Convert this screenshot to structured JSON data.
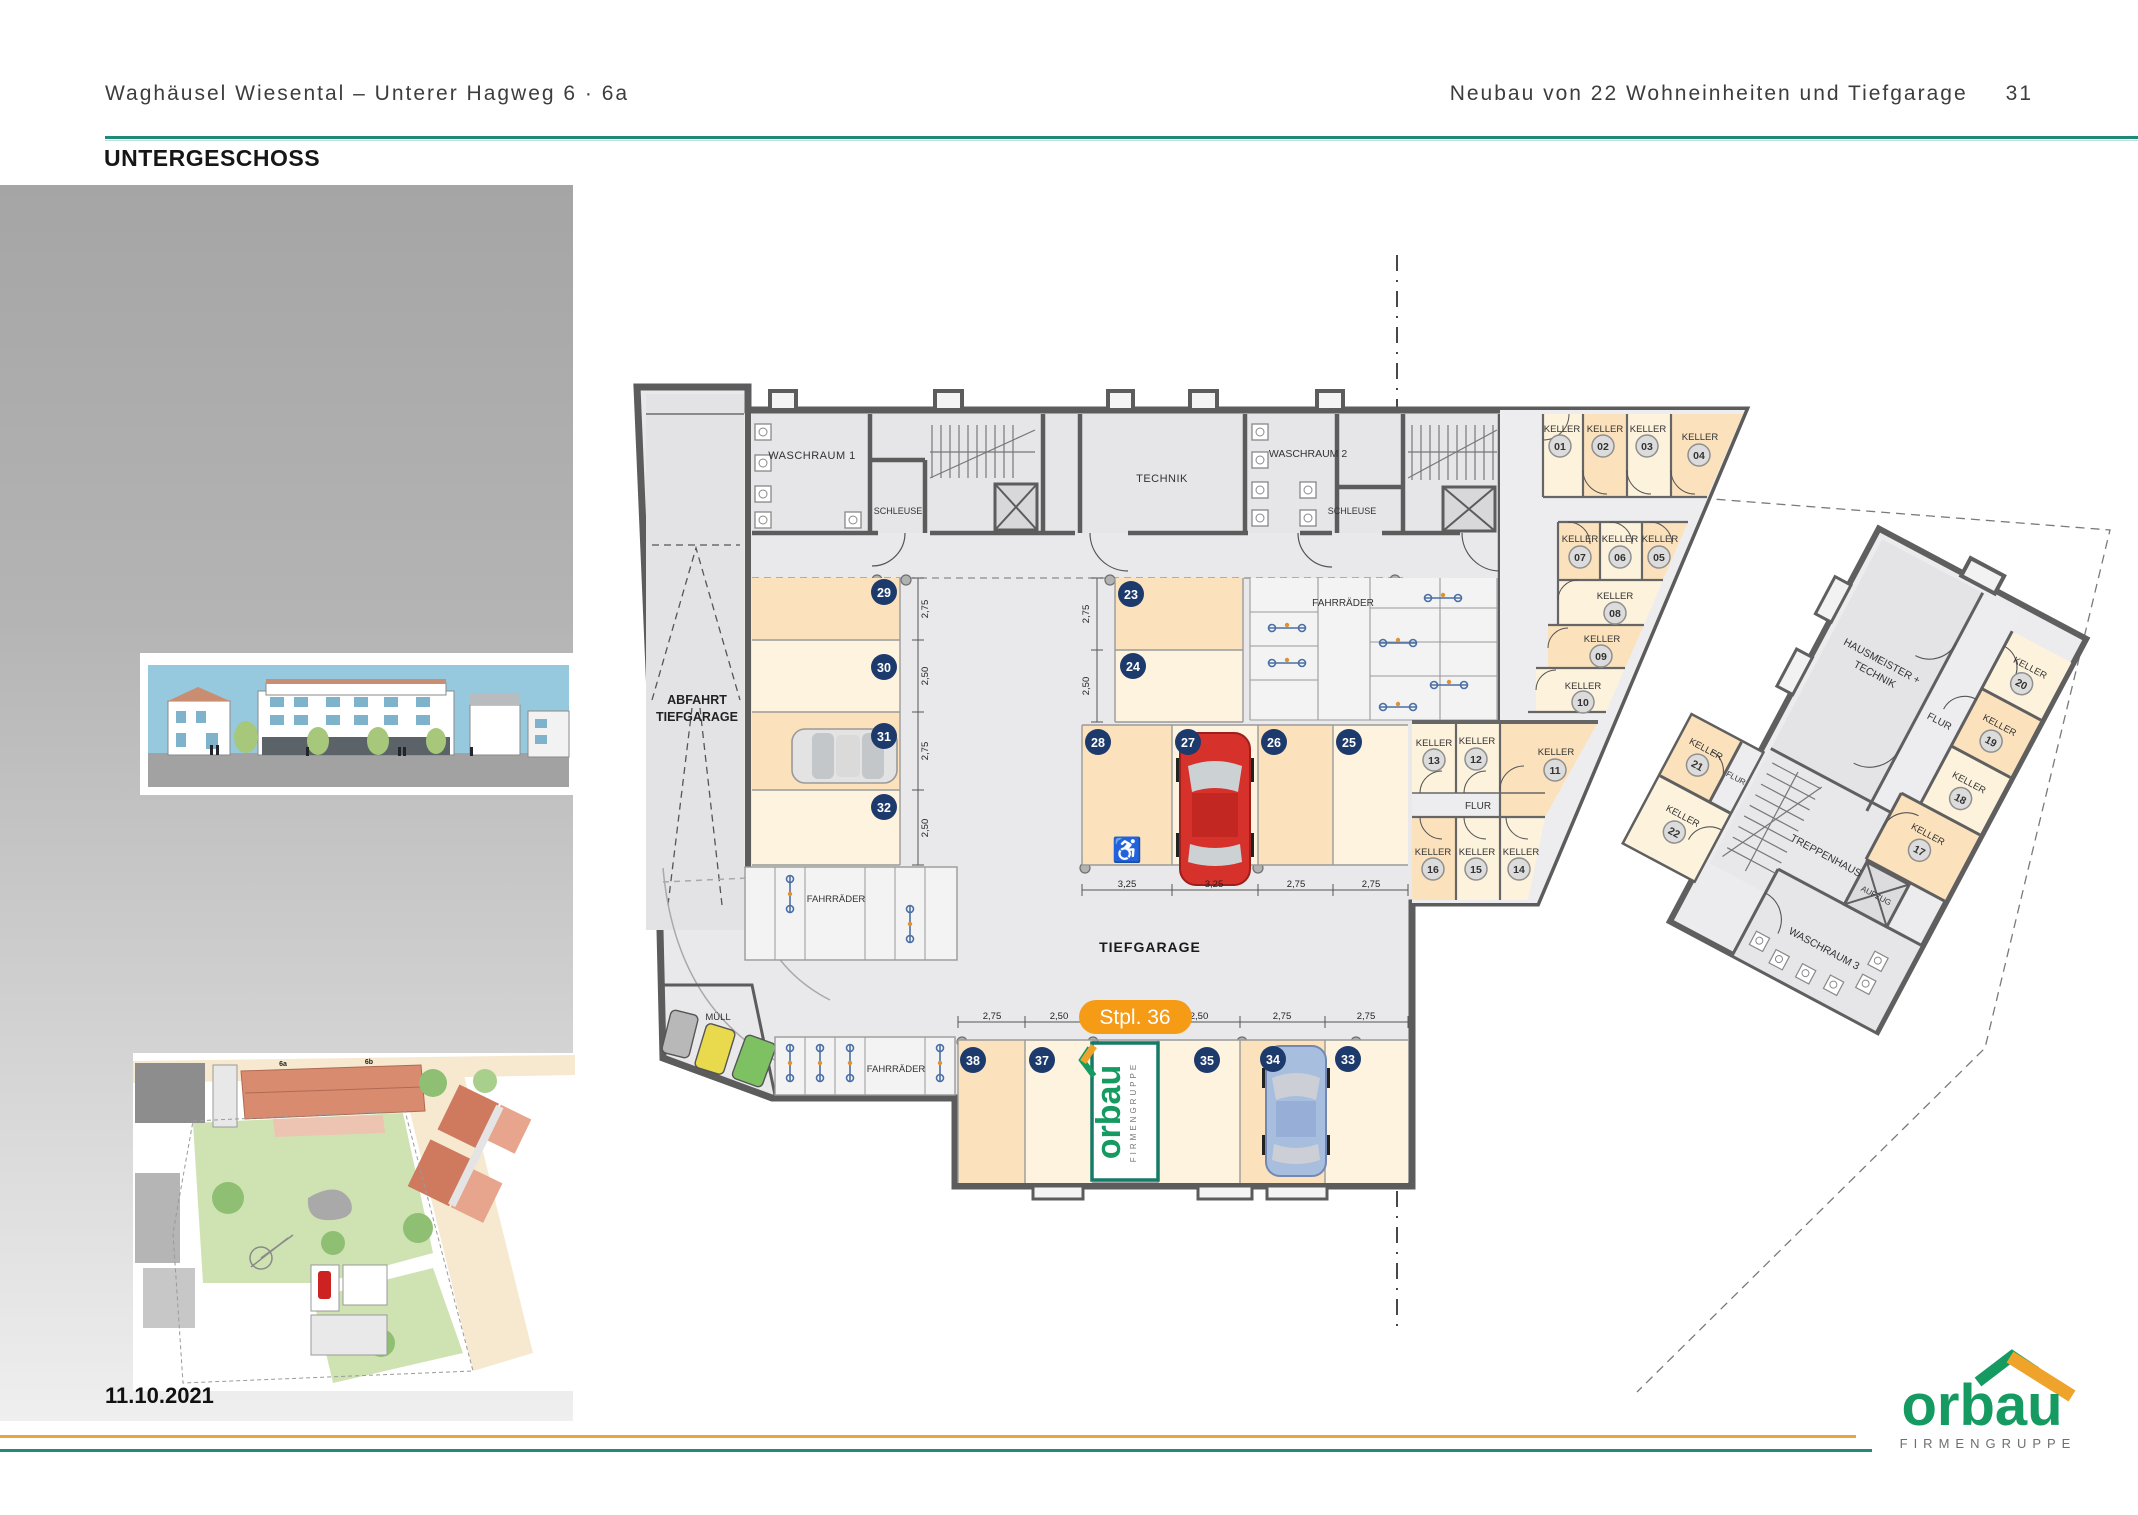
{
  "header": {
    "project": "Waghäusel Wiesental – Unterer Hagweg 6 · 6a",
    "subtitle": "Neubau von 22 Wohneinheiten und Tiefgarage",
    "page": "31"
  },
  "page_title": "UNTERGESCHOSS",
  "date": "11.10.2021",
  "logo": {
    "name": "orbau",
    "tagline": "FIRMENGRUPPE"
  },
  "plan": {
    "labels": {
      "abfahrt1": "ABFAHRT",
      "abfahrt2": "TIEFGARAGE",
      "waschraum1": "WASCHRAUM 1",
      "schleuse": "SCHLEUSE",
      "technik": "TECHNIK",
      "waschraum2": "WASCHRAUM 2",
      "fahrraeder": "FAHRRÄDER",
      "muell": "MÜLL",
      "tiefgarage": "TIEFGARAGE",
      "keller": "KELLER",
      "flur": "FLUR",
      "badge": "Stpl. 36"
    },
    "right_building": {
      "hausmeister1": "HAUSMEISTER +",
      "hausmeister2": "TECHNIK",
      "flur": "FLUR",
      "treppenhaus": "TREPPENHAUS",
      "aufzug": "AUFZUG",
      "waschraum3": "WASCHRAUM 3"
    },
    "keller_numbers": {
      "k01": "01",
      "k02": "02",
      "k03": "03",
      "k04": "04",
      "k05": "05",
      "k06": "06",
      "k07": "07",
      "k08": "08",
      "k09": "09",
      "k10": "10",
      "k11": "11",
      "k12": "12",
      "k13": "13",
      "k14": "14",
      "k15": "15",
      "k16": "16",
      "k17": "17",
      "k18": "18",
      "k19": "19",
      "k20": "20",
      "k21": "21",
      "k22": "22"
    },
    "parking_numbers": {
      "p23": "23",
      "p24": "24",
      "p25": "25",
      "p26": "26",
      "p27": "27",
      "p28": "28",
      "p29": "29",
      "p30": "30",
      "p31": "31",
      "p32": "32",
      "p33": "33",
      "p34": "34",
      "p35": "35",
      "p37": "37",
      "p38": "38"
    },
    "dims": {
      "left": [
        "2,75",
        "2,50",
        "2,75",
        "2,50"
      ],
      "right": [
        "2,75",
        "2,50"
      ],
      "middle": [
        "3,25",
        "3,25",
        "2,75",
        "2,75"
      ],
      "bottom": [
        "2,75",
        "2,50",
        "2,50",
        "2,75",
        "2,75"
      ]
    },
    "spot_logo": {
      "name": "orbau",
      "tagline": "FIRMENGRUPPE"
    }
  },
  "site_plan": {
    "house_6a": "6a",
    "house_6b": "6b"
  },
  "colors": {
    "teal": "#1f8a78",
    "orange": "#e9a43c",
    "badge": "#f59b15",
    "navy": "#1c3a6b",
    "green": "#189a62",
    "peach": "#fbe2bd",
    "cream": "#fdf3de"
  }
}
